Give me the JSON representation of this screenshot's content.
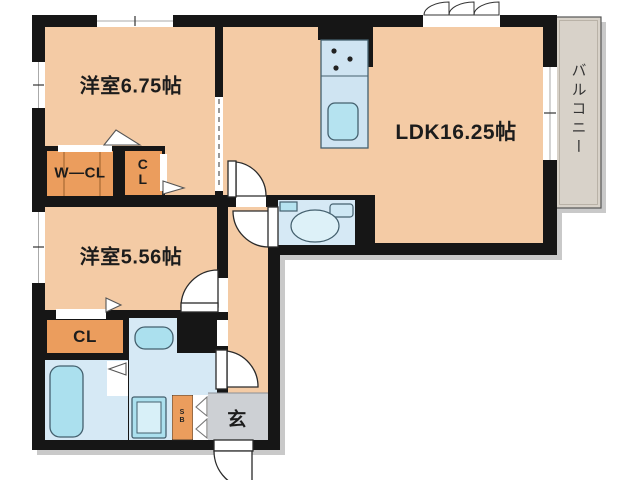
{
  "floor_plan": {
    "title": "1LDK+2 apartment floor plan",
    "rooms": {
      "western1": {
        "label": "洋室6.75帖"
      },
      "ldk": {
        "label": "LDK16.25帖"
      },
      "western2": {
        "label": "洋室5.56帖"
      },
      "wcl": {
        "label": "W—CL"
      },
      "cl_upper": {
        "label": "CL"
      },
      "cl_lower": {
        "label": "CL"
      },
      "entrance": {
        "label": "玄"
      },
      "shoebox": {
        "label": "SB"
      },
      "balcony": {
        "label": "バルコニー"
      }
    },
    "fixtures": [
      "kitchen-counter",
      "kitchen-sink",
      "stove-burners",
      "toilet",
      "toilet-paper-holder",
      "bathtub",
      "washbasin",
      "washing-machine-pan"
    ],
    "colors": {
      "wall": "#161616",
      "room_floor": "#f4cba5",
      "closet": "#eb9d5d",
      "wet_area": "#d6e9f5",
      "fixture": "#abe0ee",
      "fixture_light": "#d8f0f8",
      "balcony": "#d8d2c9",
      "entrance_floor": "#cdd0d4",
      "shadow": "#c9c9c9"
    }
  }
}
